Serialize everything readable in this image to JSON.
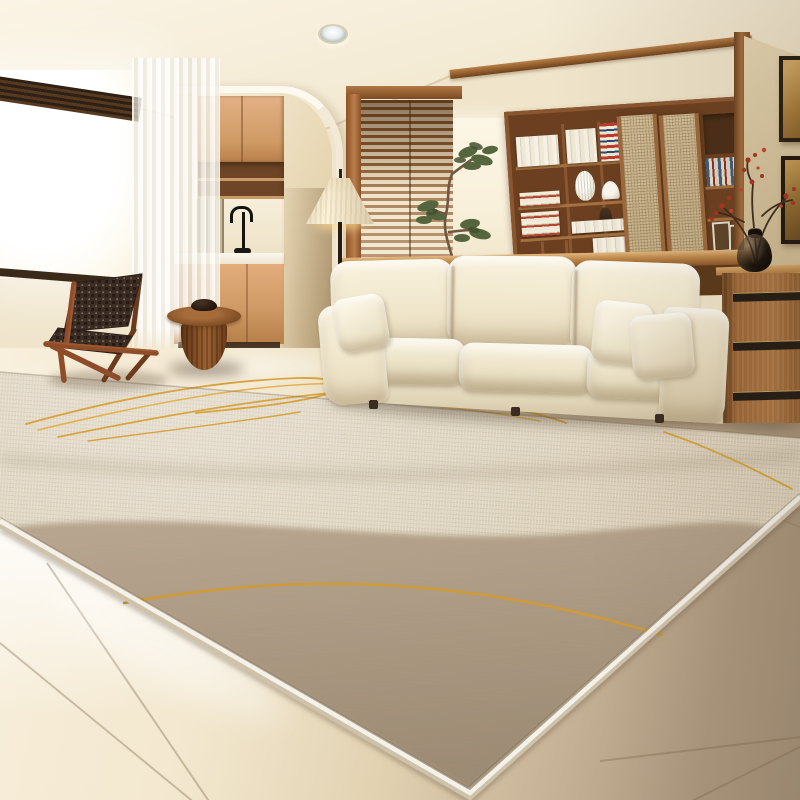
{
  "meta": {
    "type": "photograph",
    "domain_note": "No UI text present; interior product photo"
  },
  "labels": {
    "scene": "Bright modern living room with a large two-tone beige area rug",
    "ceiling": "Cream ceiling with recessed spotlight and wooden beam",
    "recessed_light": "Recessed ceiling spotlight",
    "window_left": "Large sunlit window with dark venetian blind header",
    "curtain": "Sheer white curtain",
    "kitchen": "Arched opening to kitchenette with wood cabinets",
    "faucet": "Black gooseneck faucet",
    "blinds_window": "Wood-framed window with wooden venetian blinds",
    "lit_wall": "Sunlit wall strip",
    "plant": "Small indoor tree",
    "bookshelf": "Walnut shelving unit with books, vases and rattan sliding doors",
    "rattan_doors": "Rattan sliding door panels",
    "console": "Low wooden console behind sofa",
    "right_wall": "Tan accent wall with two framed artworks",
    "frames": "Framed artworks",
    "dresser": "Walnut chest of drawers with recessed black handles",
    "vase": "Glossy black vase with red blossom branches",
    "sofa": "Cream three-seat fabric sofa with plush cushions",
    "pillows": "White throw pillows",
    "chair": "Dark woven-strap lounge chair with wooden frame",
    "side_table": "Round wooden pedestal side table with small dark bowl",
    "floor_lamp": "Floor lamp with pleated cone shade",
    "floor": "Glossy beige tile floor",
    "rug": "Large beige rug with taupe curved color block, golden accent lines and white bound edges",
    "rug_lines": "Golden curved accent lines",
    "rug_dark_region": "Taupe curved color-block region"
  },
  "palette": {
    "ceiling": "#f4ebd5",
    "wall_cream": "#f0e5cb",
    "wall_tan": "#d9c7a0",
    "wood_light": "#d09a66",
    "wood_mid": "#9c6636",
    "wood_dark": "#6b3f1f",
    "sofa_cream": "#f3ead6",
    "rug_light": "#ded3bf",
    "rug_taupe": "#a5927a",
    "rug_binding": "#f4f1e9",
    "accent_gold": "#d7a138",
    "blossom_red": "#b03828",
    "floor_light": "#f3e8cf",
    "floor_dark": "#a18e76",
    "strap_brown": "#3c2e25"
  }
}
